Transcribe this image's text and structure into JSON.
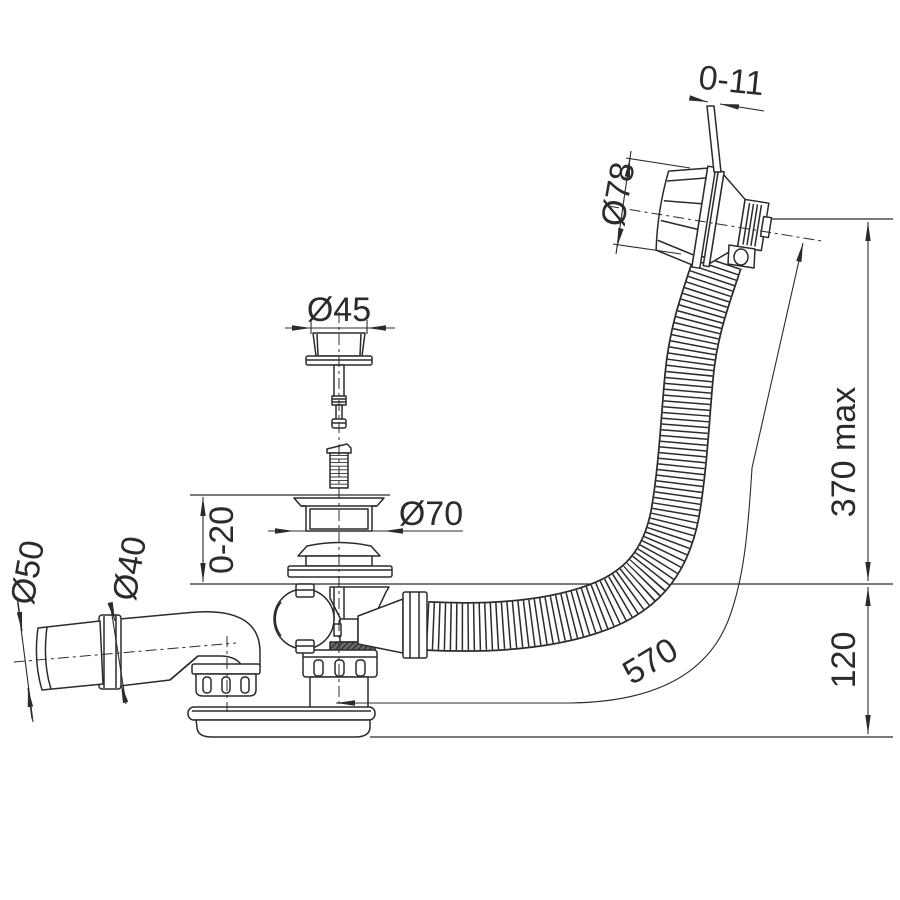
{
  "drawing": {
    "type": "technical-line-drawing",
    "subject": "bath-waste-overflow-siphon-assembly"
  },
  "colors": {
    "line": "#2b2b2b",
    "background": "#ffffff"
  },
  "dimensions": {
    "pin_stroke": {
      "label": "0-11"
    },
    "overflow_cap_diameter": {
      "label": "Ø78"
    },
    "plug_cap_diameter": {
      "label": "Ø45"
    },
    "waste_flange_diameter": {
      "label": "Ø70"
    },
    "rim_thickness_range": {
      "label": "0-20"
    },
    "outlet_end_diameter": {
      "label": "Ø50"
    },
    "outlet_pipe_diameter": {
      "label": "Ø40"
    },
    "overflow_height_max": {
      "label": "370 max"
    },
    "trap_height": {
      "label": "120"
    },
    "hose_length": {
      "label": "570"
    }
  }
}
